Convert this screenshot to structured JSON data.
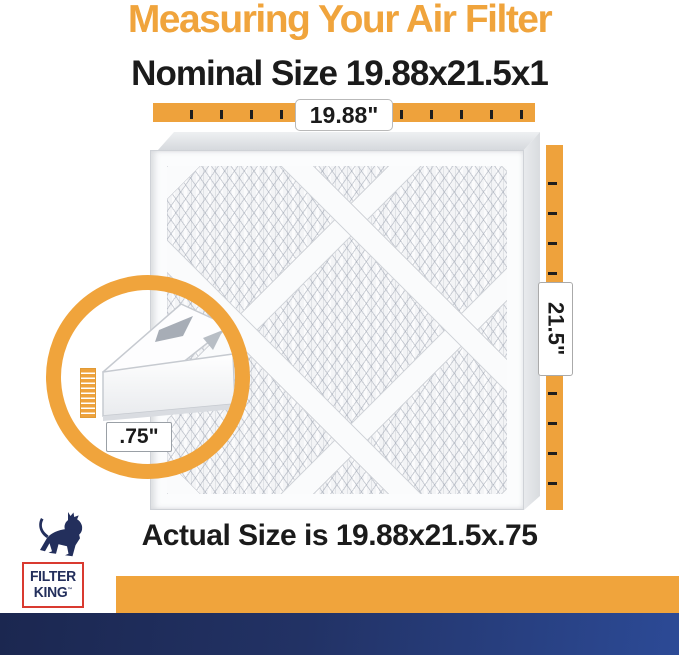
{
  "header": {
    "title": "Measuring Your Air Filter",
    "subtitle": "Nominal Size 19.88x21.5x1"
  },
  "rulers": {
    "top": {
      "label": "19.88\""
    },
    "right": {
      "label": "21.5\""
    },
    "thickness": {
      "label": ".75\""
    }
  },
  "footer": {
    "actual_size": "Actual Size is 19.88x21.5x.75"
  },
  "logo": {
    "line1": "FILTER",
    "line2": "KING",
    "tm": "™"
  },
  "colors": {
    "accent_orange": "#F0A43C",
    "ruler_orange": "#EEA23C",
    "navy": "#232f5c",
    "logo_red": "#D93A30",
    "footer_blue_start": "#1b2750",
    "footer_blue_end": "#2c4a96",
    "text_black": "#1b1b1b"
  }
}
